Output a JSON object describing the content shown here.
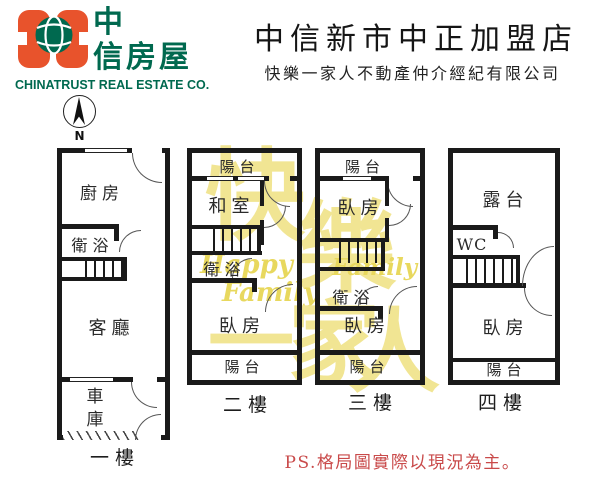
{
  "header": {
    "logo": {
      "brand_top": "中",
      "brand_bottom": "信房屋",
      "company_en": "CHINATRUST REAL ESTATE CO.",
      "orange": "#E8532C",
      "green": "#00694F"
    },
    "store_title": "中信新市中正加盟店",
    "subtitle": "快樂一家人不動產仲介經紀有限公司"
  },
  "compass": {
    "north": "N"
  },
  "floors": [
    {
      "label": "一樓",
      "kitchen": "廚房",
      "bath": "衛浴",
      "living": "客廳",
      "garage": "車庫"
    },
    {
      "label": "二樓",
      "balcony_top": "陽台",
      "tatami": "和室",
      "bath": "衛浴",
      "bedroom": "臥房",
      "balcony_bottom": "陽台"
    },
    {
      "label": "三樓",
      "balcony_top": "陽台",
      "bedroom_top": "臥房",
      "bath": "衛浴",
      "bedroom_bottom": "臥房",
      "balcony_bottom": "陽台"
    },
    {
      "label": "四樓",
      "terrace": "露台",
      "wc": "WC",
      "bedroom": "臥房",
      "balcony": "陽台"
    }
  ],
  "watermark": {
    "char1": "快",
    "char2": "樂",
    "char3": "一",
    "char4": "家",
    "char5": "人",
    "script1": "Happy",
    "script2": "Family",
    "color": "#F1E593"
  },
  "footnote": {
    "text": "PS.格局圖實際以現況為主。",
    "color": "#C94A4A"
  },
  "colors": {
    "line_black": "#1A1A1A",
    "brand_orange": "#E8532C",
    "brand_green": "#00694F"
  }
}
